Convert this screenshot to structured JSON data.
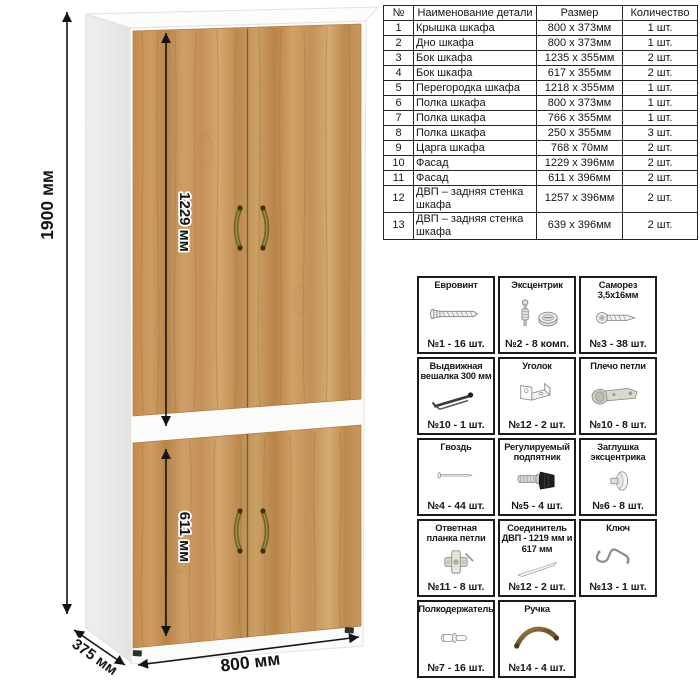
{
  "dimensions": {
    "height": "1900 мм",
    "upper_front": "1229 мм",
    "lower_front": "611 мм",
    "width": "800 мм",
    "depth": "375 мм"
  },
  "parts_table": {
    "headers": [
      "№",
      "Наименование детали",
      "Размер",
      "Количество"
    ],
    "rows": [
      [
        "1",
        "Крышка шкафа",
        "800 х 373мм",
        "1 шт."
      ],
      [
        "2",
        "Дно шкафа",
        "800 х 373мм",
        "1 шт."
      ],
      [
        "3",
        "Бок шкафа",
        "1235 х 355мм",
        "2 шт."
      ],
      [
        "4",
        "Бок шкафа",
        "617 х 355мм",
        "2 шт."
      ],
      [
        "5",
        "Перегородка шкафа",
        "1218 х 355мм",
        "1 шт."
      ],
      [
        "6",
        "Полка шкафа",
        "800 х 373мм",
        "1 шт."
      ],
      [
        "7",
        "Полка шкафа",
        "766 х 355мм",
        "1 шт."
      ],
      [
        "8",
        "Полка шкафа",
        "250 х 355мм",
        "3 шт."
      ],
      [
        "9",
        "Царга шкафа",
        "768 х 70мм",
        "2 шт."
      ],
      [
        "10",
        "Фасад",
        "1229 х 396мм",
        "2 шт."
      ],
      [
        "11",
        "Фасад",
        "611 х 396мм",
        "2 шт."
      ],
      [
        "12",
        "ДВП – задняя стенка шкафа",
        "1257 х 396мм",
        "2 шт."
      ],
      [
        "13",
        "ДВП – задняя стенка шкафа",
        "639 х 396мм",
        "2 шт."
      ]
    ]
  },
  "hardware": {
    "items": [
      {
        "title": "Евровинт",
        "icon": "euro-screw",
        "caption": "№1 - 16 шт."
      },
      {
        "title": "Эксцентрик",
        "icon": "eccentric-cam",
        "caption": "№2 - 8 комп."
      },
      {
        "title": "Саморез 3,5х16мм",
        "icon": "self-tapping-screw",
        "caption": "№3 - 38 шт."
      },
      {
        "title": "Выдвижная вешалка 300 мм",
        "icon": "pullout-hanger",
        "caption": "№10 - 1 шт."
      },
      {
        "title": "Уголок",
        "icon": "corner-bracket",
        "caption": "№12 - 2 шт."
      },
      {
        "title": "Плечо петли",
        "icon": "hinge-arm",
        "caption": "№10 - 8 шт."
      },
      {
        "title": "Гвоздь",
        "icon": "nail",
        "caption": "№4 - 44 шт."
      },
      {
        "title": "Регулируемый подпятник",
        "icon": "adjustable-foot",
        "caption": "№5 - 4 шт."
      },
      {
        "title": "Заглушка эксцентрика",
        "icon": "cam-cover",
        "caption": "№6 - 8 шт."
      },
      {
        "title": "Ответная планка петли",
        "icon": "hinge-plate",
        "caption": "№11 - 8 шт."
      },
      {
        "title": "Соединитель ДВП - 1219 мм и 617 мм",
        "icon": "hdf-connector",
        "caption": "№12 - 2 шт."
      },
      {
        "title": "Ключ",
        "icon": "key",
        "caption": "№13 - 1 шт."
      },
      {
        "title": "Полкодержатель",
        "icon": "shelf-pin",
        "caption": "№7 - 16 шт."
      },
      {
        "title": "Ручка",
        "icon": "handle",
        "caption": "№14 - 4 шт."
      }
    ]
  },
  "colors": {
    "wood": "#c49257",
    "wood_grain": "#8f6a3a",
    "carcass_white": "#fbfbfa",
    "handle_bronze": "#6d6128",
    "line_black": "#141414",
    "table_border": "#262626"
  }
}
